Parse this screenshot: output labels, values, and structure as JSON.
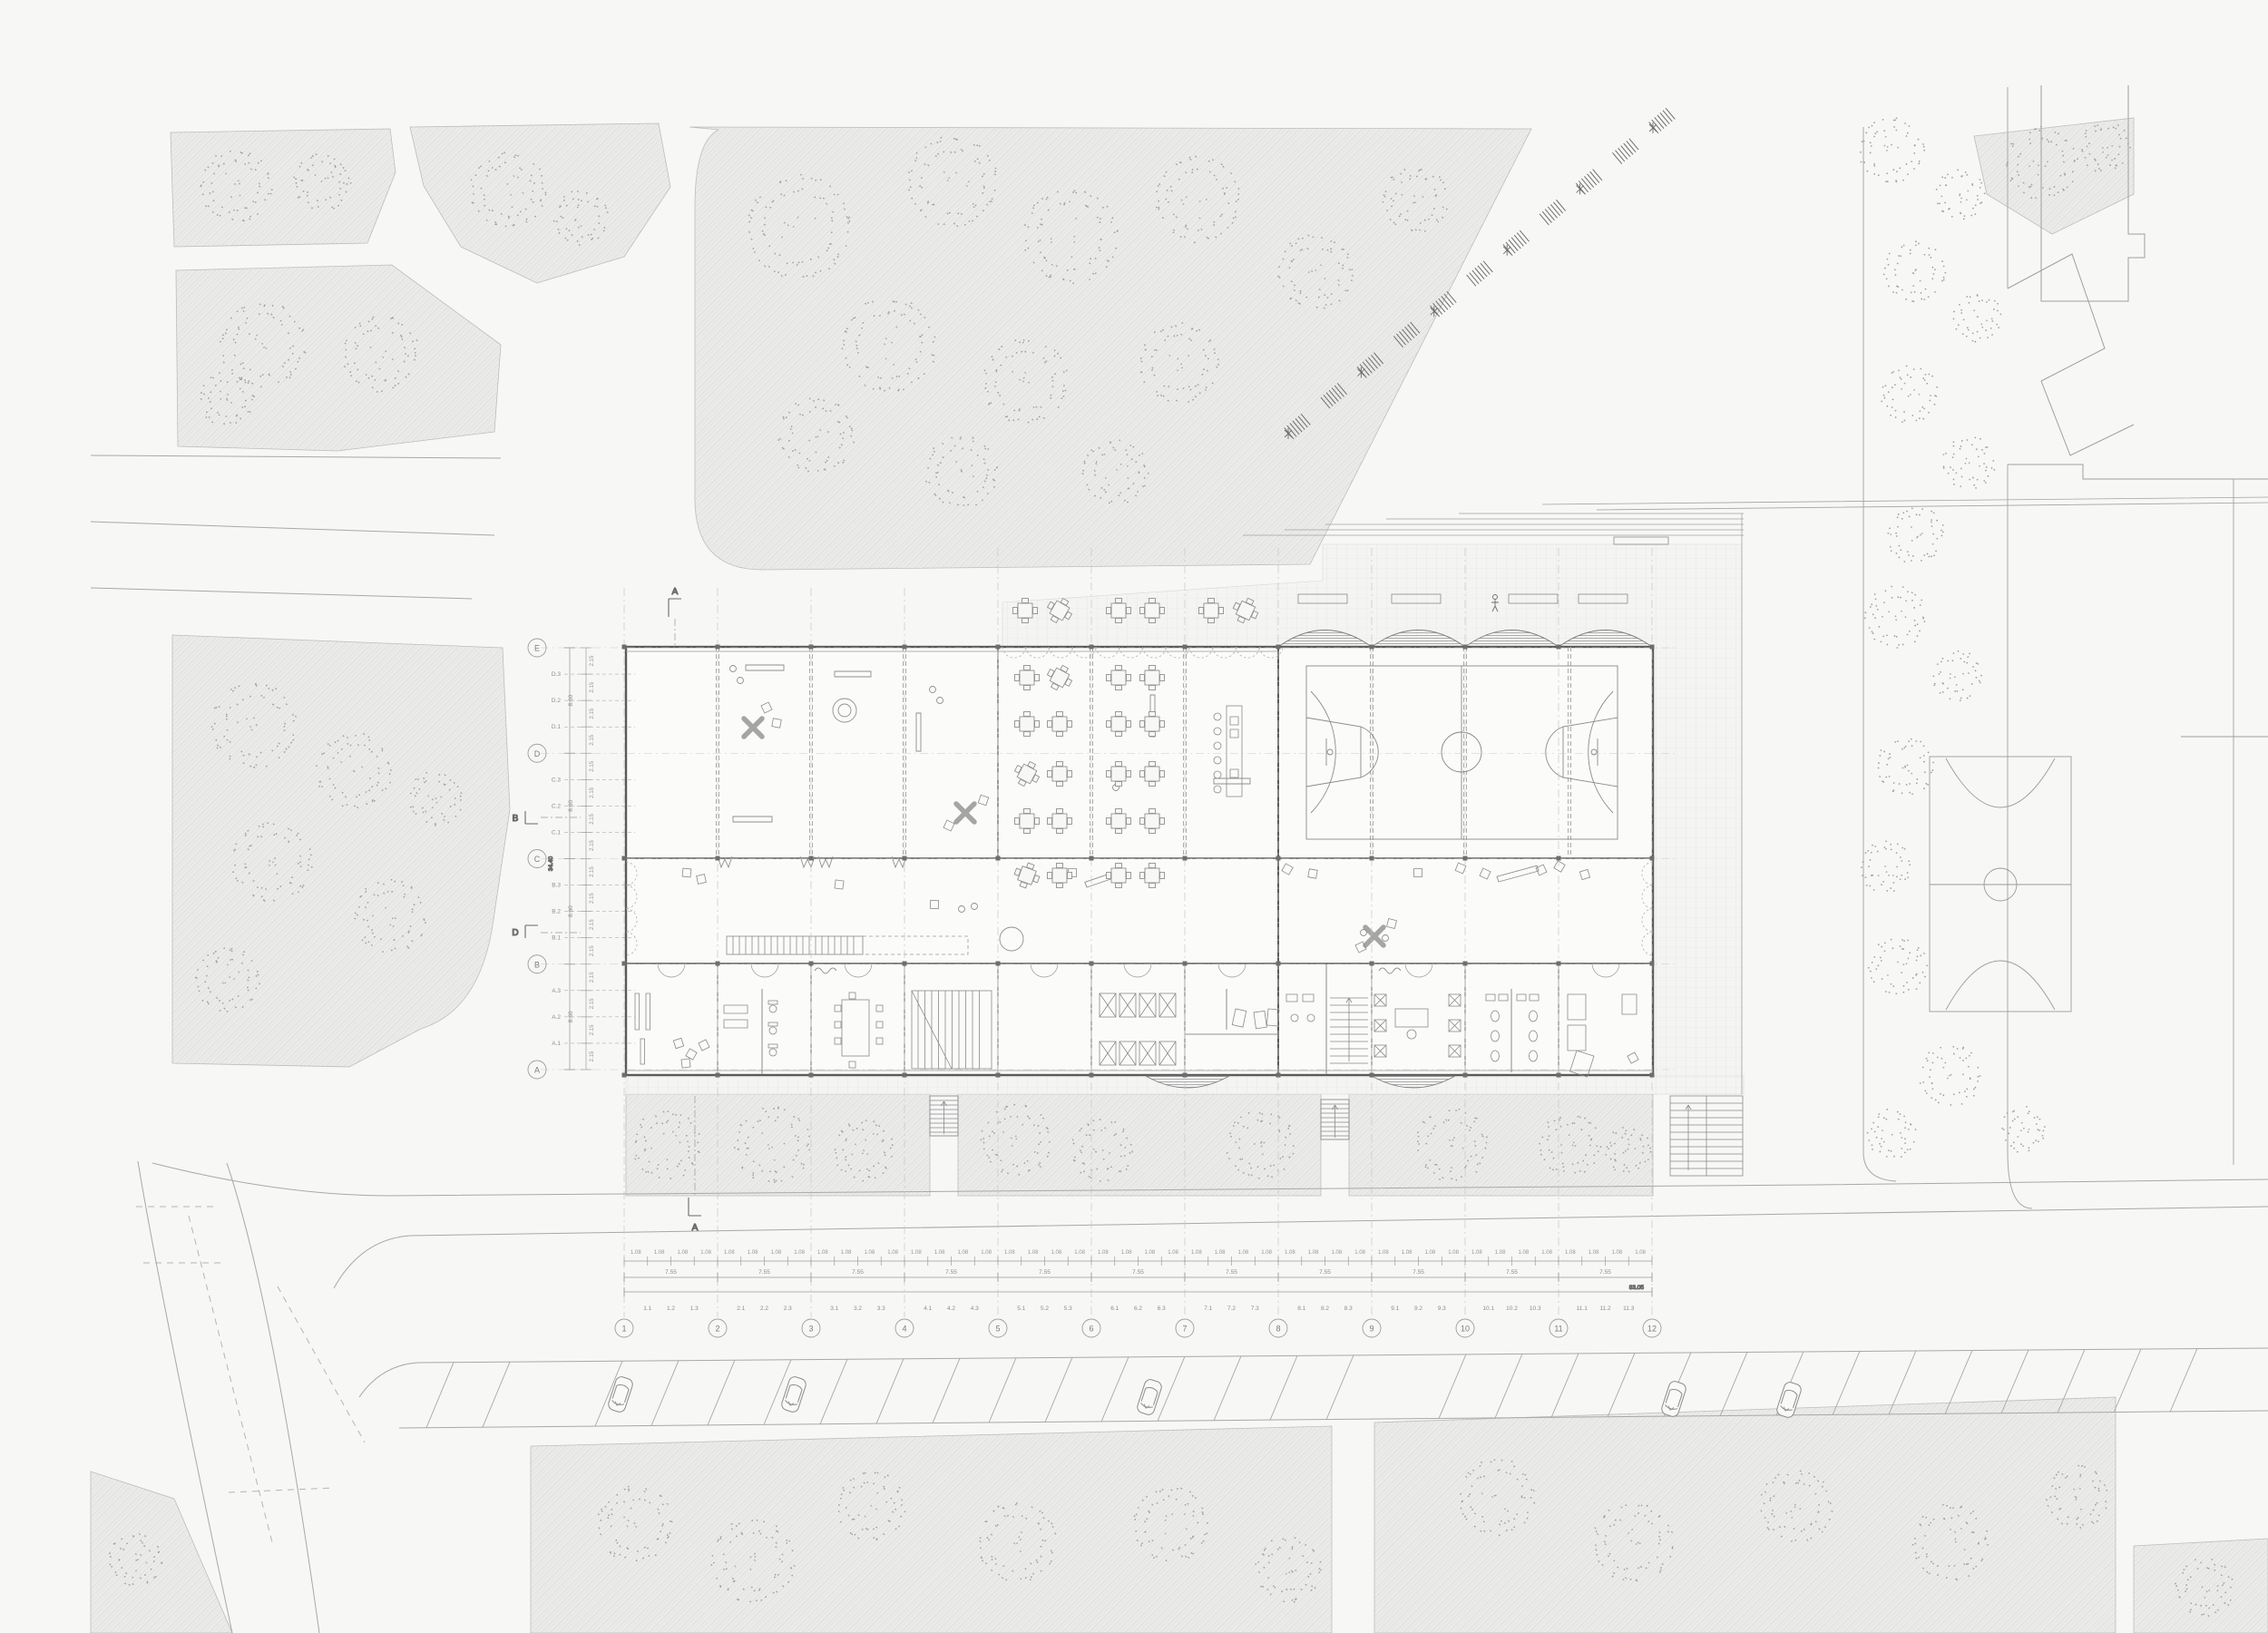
{
  "drawing": {
    "type": "architectural site plan, school ground floor with gym and schoolyard",
    "background_color": "#f7f7f6",
    "wall_ink": "#5a5a5a",
    "line_ink": "#9a9a9a",
    "vegetation_fill": "#ebebea"
  },
  "axes": {
    "row_letters": [
      "A",
      "B",
      "C",
      "D",
      "E"
    ],
    "row_intermediates": [
      "A.1",
      "A.2",
      "A.3",
      "B.1",
      "B.2",
      "B.3",
      "C.1",
      "C.2",
      "C.3",
      "D.1",
      "D.2",
      "D.3"
    ],
    "col_numbers": [
      "1",
      "2",
      "3",
      "4",
      "5",
      "6",
      "7",
      "8",
      "9",
      "10",
      "11",
      "12"
    ],
    "col_intermediates": [
      "1.1",
      "1.2",
      "1.3",
      "2.1",
      "2.2",
      "2.3",
      "3.1",
      "3.2",
      "3.3",
      "4.1",
      "4.2",
      "4.3",
      "5.1",
      "5.2",
      "5.3",
      "6.1",
      "6.2",
      "6.3",
      "7.1",
      "7.2",
      "7.3",
      "8.1",
      "8.2",
      "8.3",
      "9.1",
      "9.2",
      "9.3",
      "10.1",
      "10.2",
      "10.3",
      "11.1",
      "11.2",
      "11.3"
    ],
    "dims": {
      "col_module": "1.08",
      "col_bay": "7.55",
      "col_total": "83.05",
      "row_module": "2.15",
      "row_bay": "8.60",
      "row_total": "34.40"
    }
  },
  "section_markers": {
    "north": "A",
    "south": "A",
    "west_upper": "B",
    "west_lower": "D"
  }
}
